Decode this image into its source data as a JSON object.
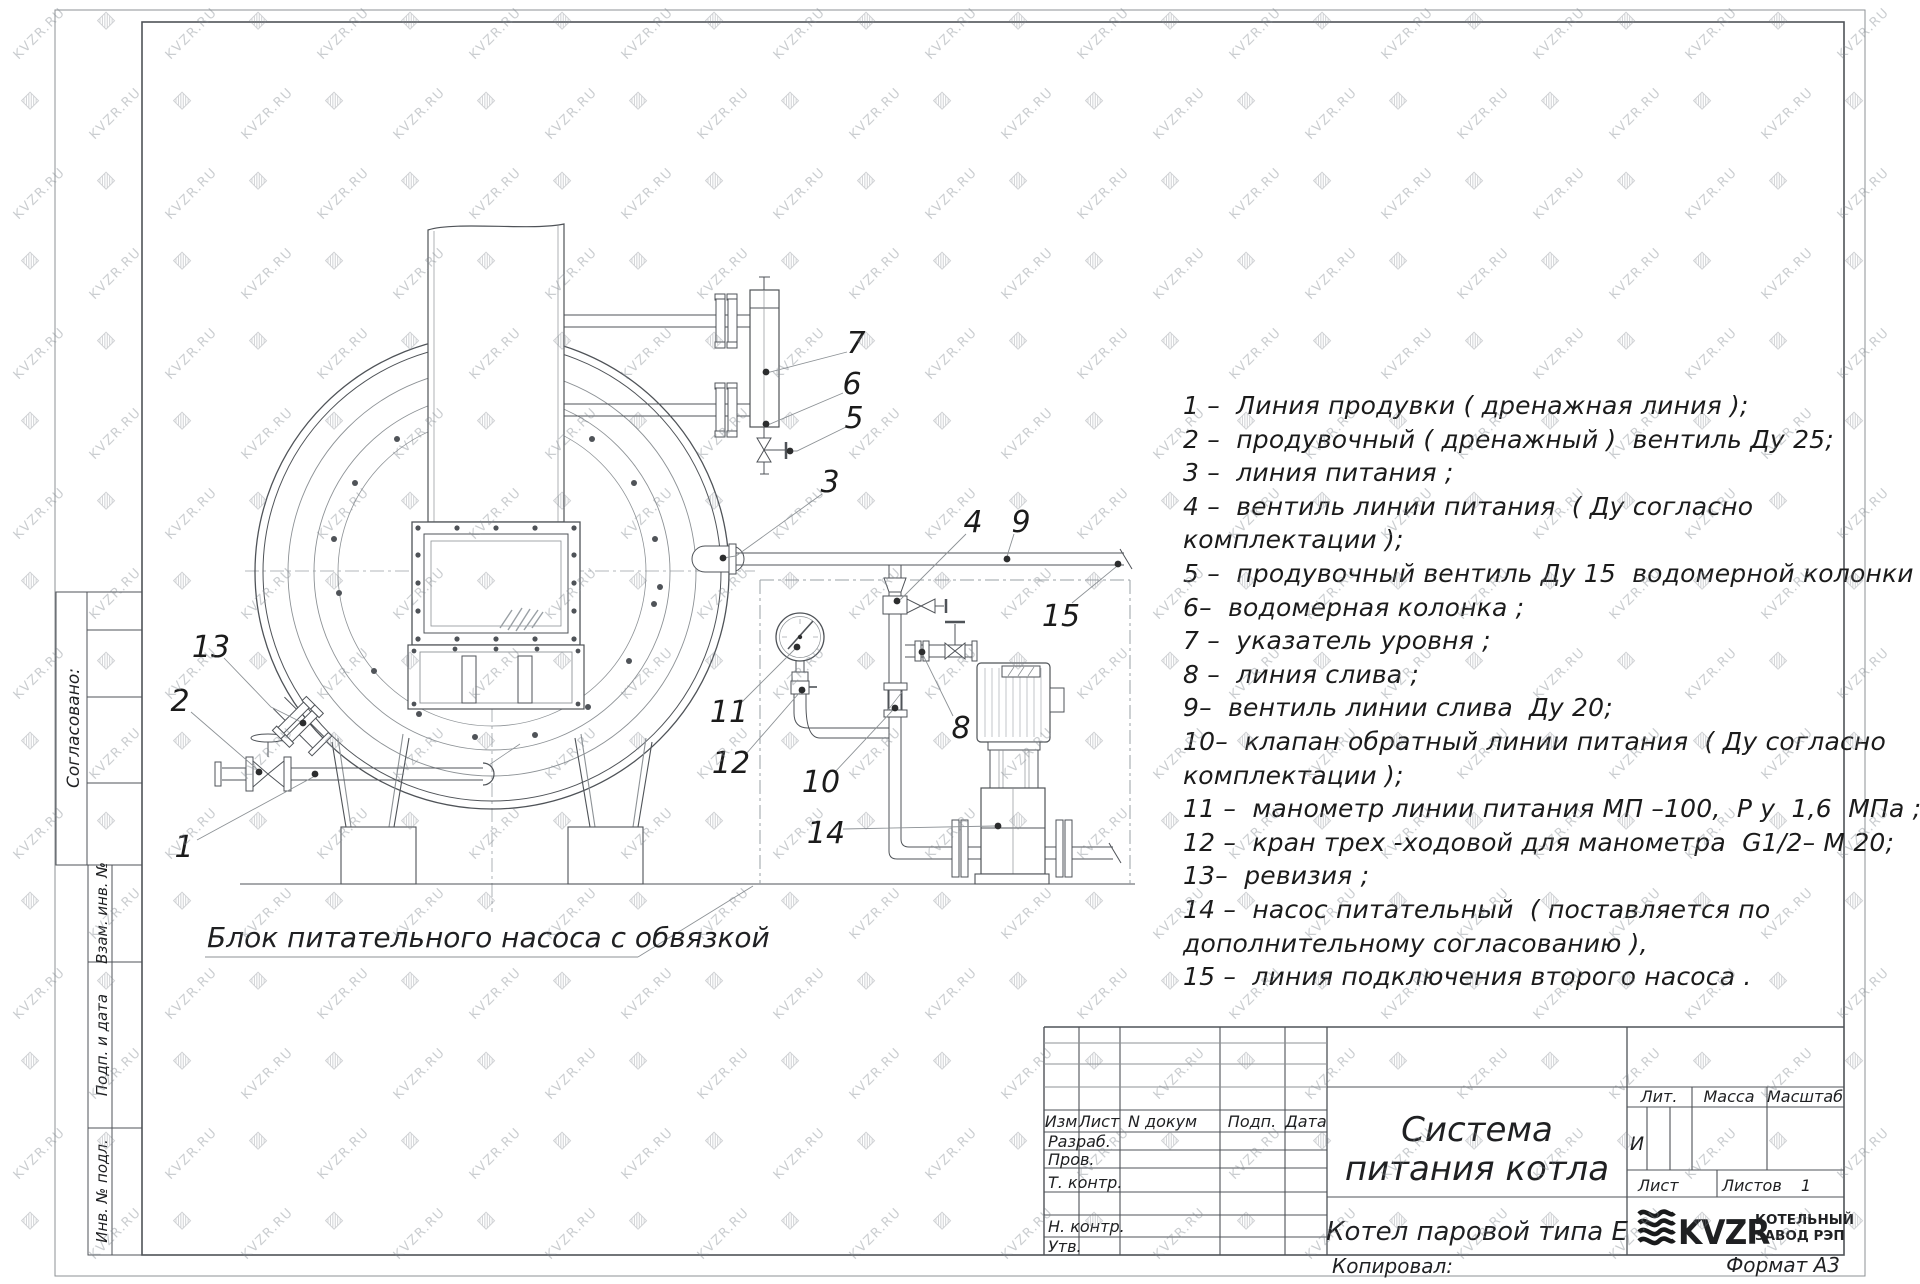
{
  "watermark": {
    "text": "KVZR.RU",
    "glyph": "▨"
  },
  "side_stamps": {
    "soglasovano": "Согласовано:",
    "vzam": "Взам. инв. №",
    "podp_data": "Подп. и дата",
    "inv_podl": "Инв. № подл."
  },
  "drawing": {
    "block_label": "Блок питательного насоса с обвязкой"
  },
  "callouts": [
    {
      "n": "1",
      "label": [
        184,
        846
      ],
      "leader": [
        [
          197,
          840
        ],
        [
          315,
          776
        ]
      ],
      "dot": [
        315,
        774
      ]
    },
    {
      "n": "2",
      "label": [
        180,
        700
      ],
      "leader": [
        [
          191,
          712
        ],
        [
          258,
          770
        ]
      ],
      "dot": [
        259,
        772
      ]
    },
    {
      "n": "13",
      "label": [
        211,
        646
      ],
      "leader": [
        [
          224,
          658
        ],
        [
          271,
          707
        ],
        [
          301,
          722
        ]
      ],
      "dot": [
        303,
        723
      ]
    },
    {
      "n": "3",
      "label": [
        830,
        481
      ],
      "leader": [
        [
          822,
          494
        ],
        [
          736,
          556
        ]
      ],
      "dot": [
        723,
        558
      ]
    },
    {
      "n": "5",
      "label": [
        854,
        417
      ],
      "leader": [
        [
          846,
          427
        ],
        [
          797,
          451
        ]
      ],
      "dot": [
        790,
        451
      ]
    },
    {
      "n": "6",
      "label": [
        852,
        383
      ],
      "leader": [
        [
          843,
          393
        ],
        [
          770,
          424
        ]
      ],
      "dot": [
        766,
        424
      ]
    },
    {
      "n": "7",
      "label": [
        856,
        342
      ],
      "leader": [
        [
          847,
          352
        ],
        [
          770,
          372
        ]
      ],
      "dot": [
        766,
        372
      ]
    },
    {
      "n": "4",
      "label": [
        973,
        521
      ],
      "leader": [
        [
          966,
          534
        ],
        [
          901,
          599
        ]
      ],
      "dot": [
        897,
        601
      ]
    },
    {
      "n": "9",
      "label": [
        1021,
        521
      ],
      "leader": [
        [
          1014,
          534
        ],
        [
          1008,
          553
        ]
      ],
      "dot": [
        1007,
        559
      ]
    },
    {
      "n": "15",
      "label": [
        1061,
        615
      ],
      "leader": [
        [
          1072,
          603
        ],
        [
          1116,
          567
        ]
      ],
      "dot": [
        1118,
        564
      ]
    },
    {
      "n": "11",
      "label": [
        729,
        711
      ],
      "leader": [
        [
          742,
          702
        ],
        [
          795,
          649
        ]
      ],
      "dot": [
        797,
        647
      ]
    },
    {
      "n": "12",
      "label": [
        731,
        762
      ],
      "leader": [
        [
          746,
          754
        ],
        [
          800,
          692
        ]
      ],
      "dot": [
        802,
        690
      ]
    },
    {
      "n": "10",
      "label": [
        821,
        781
      ],
      "leader": [
        [
          834,
          773
        ],
        [
          892,
          711
        ]
      ],
      "dot": [
        895,
        708
      ]
    },
    {
      "n": "14",
      "label": [
        826,
        832
      ],
      "leader": [
        [
          843,
          829
        ],
        [
          995,
          826
        ]
      ],
      "dot": [
        998,
        826
      ]
    },
    {
      "n": "8",
      "label": [
        961,
        727
      ],
      "leader": [
        [
          953,
          716
        ],
        [
          923,
          655
        ]
      ],
      "dot": [
        922,
        652
      ]
    }
  ],
  "legend": {
    "lines": [
      "1 –  Линия продувки ( дренажная линия );",
      "2 –  продувочный ( дренажный )  вентиль Ду 25;",
      "3 –  линия питания ;",
      "4 –  вентиль линии питания  ( Ду согласно",
      "комплектации );",
      "5 –  продувочный вентиль Ду 15  водомерной колонки ;",
      "6–  водомерная колонка ;",
      "7 –  указатель уровня ;",
      "8 –  линия слива ;",
      "9–  вентиль линии слива  Ду 20;",
      "10–  клапан обратный линии питания  ( Ду согласно",
      "комплектации );",
      "11 –  манометр линии питания МП –100,  Р у  1,6  МПа ;",
      "12 –  кран трех -ходовой для манометра  G1/2– М 20;",
      "13–  ревизия ;",
      "14 –  насос питательный  ( поставляется по",
      "дополнительному согласованию ),",
      "15 –  линия подключения второго насоса ."
    ]
  },
  "title_block": {
    "title_line1": "Система",
    "title_line2": "питания котла",
    "product": "Котел паровой типа Е",
    "cols": {
      "izm": "Изм",
      "list": "Лист",
      "n_dokum": "N докум",
      "podp": "Подп.",
      "data": "Дата"
    },
    "rows": {
      "razrab": "Разраб.",
      "prov": "Пров.",
      "t_kontr": "Т. контр.",
      "n_kontr": "Н. контр.",
      "utv": "Утв."
    },
    "lit_label": "Лит.",
    "lit_value": "И",
    "massa": "Масса",
    "masshtab": "Масштаб",
    "list_label": "Лист",
    "listov_label": "Листов",
    "listov_value": "1",
    "logo_text": "KVZR",
    "company_line1": "КОТЕЛЬНЫЙ",
    "company_line2": "ЗАВОД РЭП",
    "kopiroval": "Копировал:",
    "format": "Формат А3"
  }
}
